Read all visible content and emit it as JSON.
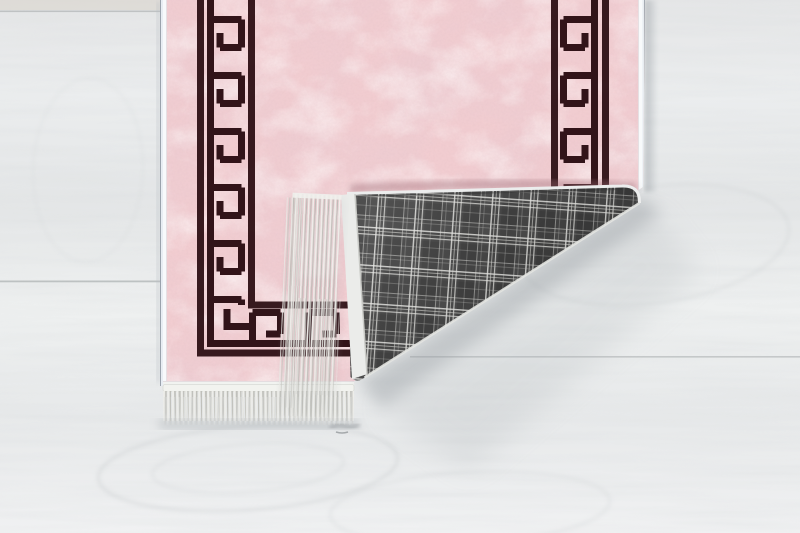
{
  "meta": {
    "type": "product-photo",
    "subject": "Pink Greek-key rug with corner folded over on a light wooden floor"
  },
  "scene": {
    "floor": {
      "label": "light gray wooden plank floor"
    },
    "rug": {
      "label": "pink rug with dark greek key meander border",
      "pattern": "greek-key-meander",
      "front_color_name": "powder pink"
    },
    "backing": {
      "label": "gray plaid woven backing shown on folded corner",
      "pattern": "tartan-check"
    },
    "fold": {
      "label": "bottom-right corner folded over revealing backing"
    },
    "fringe": {
      "label": "white fringe tassels on rug ends"
    }
  },
  "colors": {
    "floor_base": "#e9eaeb",
    "floor_seam": "#b5b9ba",
    "rug_pink": "#f2cdd1",
    "rug_pink_deep": "#d79ca6",
    "rug_pink_light": "#fae9ea",
    "border_dark": "#321419",
    "selvedge_white": "#f1f3f0",
    "plaid_base": "#484848",
    "plaid_line": "#e6e6e3",
    "fringe_light": "#e9e9e5",
    "fringe_shadow": "#c7c7c2",
    "shadow_gray": "#8f969c"
  }
}
